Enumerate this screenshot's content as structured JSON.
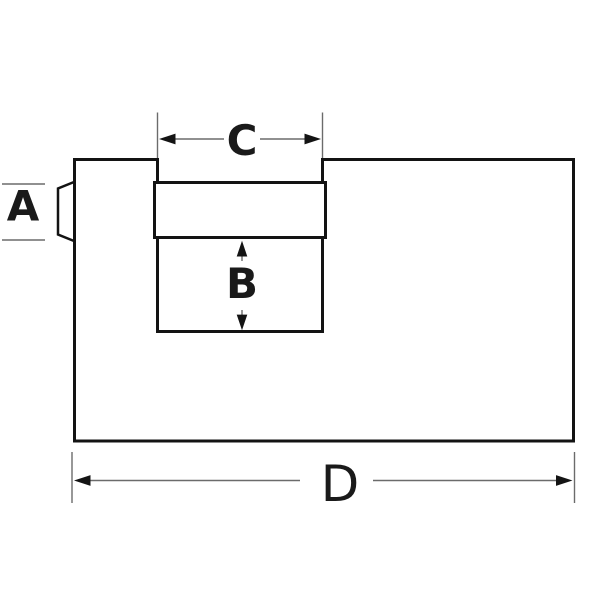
{
  "diagram": {
    "labels": {
      "a": "A",
      "b": "B",
      "c": "C",
      "d": "D"
    }
  },
  "colors": {
    "background": "#ffffff",
    "outline": "#131313",
    "dimension_line": "#6b6b6b",
    "arrowhead": "#141414",
    "label_text": "#1a1a1a"
  }
}
